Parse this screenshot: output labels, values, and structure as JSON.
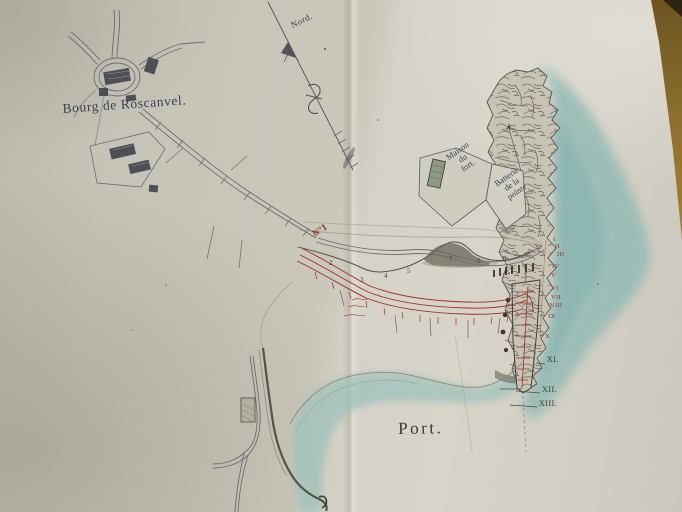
{
  "labels": {
    "village": "Bourg de Roscanvel.",
    "north": "Nord.",
    "maison_du_fort": {
      "line1": "Maison",
      "line2": "du",
      "line3": "fort."
    },
    "batterie": {
      "line1": "Batterie",
      "line2": "de la",
      "line3": "pointe"
    },
    "port": "Port.",
    "route_number": "N°1"
  },
  "route_stations": [
    "2",
    "3",
    "4",
    "5",
    "7",
    "8",
    "9"
  ],
  "survey_points": {
    "red": [
      "I",
      "II",
      "III",
      "IV",
      "V",
      "VI",
      "VII",
      "VIII",
      "IX",
      "X"
    ],
    "dark": [
      "XI.",
      "XII.",
      "XIII."
    ]
  },
  "icons": {
    "north_arrow": "north-arrow-with-fleur",
    "buildings": "hatched-building-blocks"
  },
  "colors": {
    "paper": "#cdcabf",
    "sea_wash": "#8fbab4",
    "ink_dark": "#4c4956",
    "ink_red": "#9b3028",
    "building_green": "#8d9983",
    "table_edge_brown": "#96782f"
  }
}
